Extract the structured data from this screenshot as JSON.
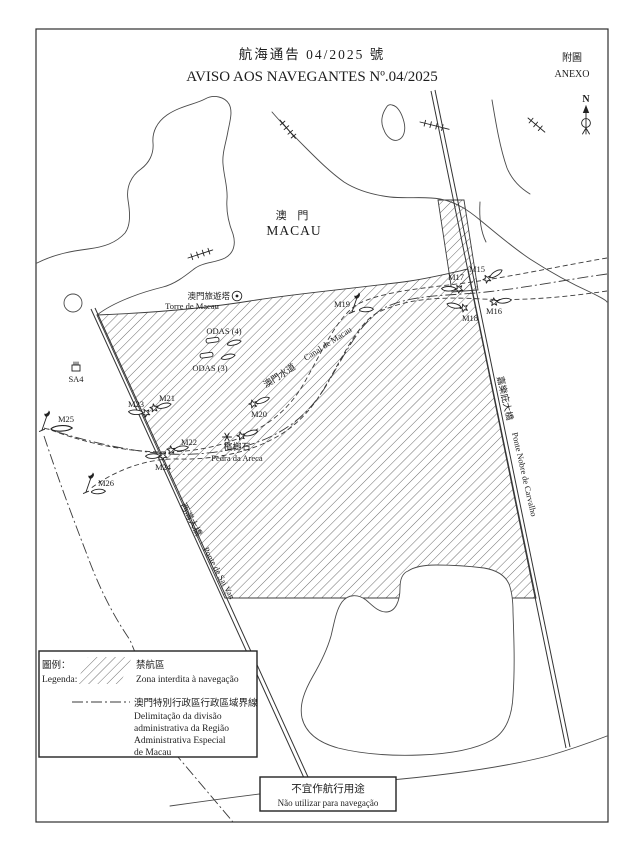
{
  "colors": {
    "ink": "#333333",
    "paper": "#ffffff"
  },
  "title": {
    "zh": "航海通告 04/2025 號",
    "pt": "AVISO AOS NAVEGANTES Nº.04/2025"
  },
  "annex": {
    "zh": "附圖",
    "pt": "ANEXO"
  },
  "compass": {
    "n": "N"
  },
  "map": {
    "region": {
      "zh": "澳 門",
      "pt": "MACAU"
    },
    "tower": {
      "zh": "澳門旅遊塔",
      "pt": "Torre de Macau"
    },
    "channel": {
      "zh": "澳門水道",
      "pt": "Canal de Macau"
    },
    "bridge_saivan": {
      "zh": "西灣大橋",
      "pt": "Ponte de Sai Van"
    },
    "bridge_nobre": {
      "zh": "嘉樂庇大橋",
      "pt": "Ponte Nobre de Carvalho"
    },
    "rock": {
      "zh": "檳榔石",
      "pt": "Pedra da Areca"
    },
    "odas4": "ODAS (4)",
    "odas3": "ODAS (3)",
    "sa4": "SA4",
    "buoys": {
      "m15": "M15",
      "m16": "M16",
      "m17": "M17",
      "m18": "M18",
      "m19": "M19",
      "m20": "M20",
      "m21": "M21",
      "m22": "M22",
      "m23": "M23",
      "m24": "M24",
      "m25": "M25",
      "m26": "M26"
    }
  },
  "legend": {
    "title_zh": "圖例：",
    "title_pt": "Legenda:",
    "zone_zh": "禁航區",
    "zone_pt": "Zona interdita à navegação",
    "boundary_zh": "澳門特別行政區行政區域界線",
    "boundary_pt_1": "Delimitação da divisão",
    "boundary_pt_2": "administrativa da Região",
    "boundary_pt_3": "Administrativa Especial",
    "boundary_pt_4": "de Macau"
  },
  "note": {
    "zh": "不宜作航行用途",
    "pt": "Não utilizar para navegação"
  }
}
